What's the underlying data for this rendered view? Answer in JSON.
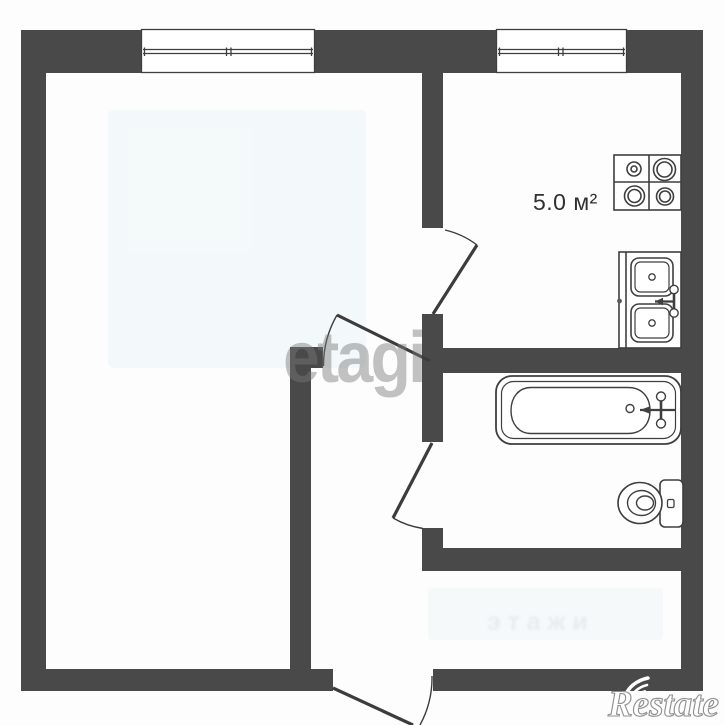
{
  "colors": {
    "wall": "#494949",
    "line": "#3f3f3f",
    "door": "#3c3c3c",
    "background": "#fdfdfd",
    "area_label": "#303030"
  },
  "labels": {
    "kitchen_area": "5.0 м²"
  },
  "watermarks": {
    "etagi": "etagi",
    "restate": "Restate",
    "faint_center": "этажи"
  },
  "fixtures": {
    "stove": "stove-4-burner",
    "sink": "double-kitchen-sink-with-faucet",
    "bathtub": "bathtub-with-faucet",
    "toilet": "toilet-with-tank",
    "windows": [
      "window-main-room",
      "window-kitchen"
    ],
    "doors": [
      "door-kitchen",
      "door-main-room",
      "door-bathroom",
      "door-entrance"
    ]
  }
}
